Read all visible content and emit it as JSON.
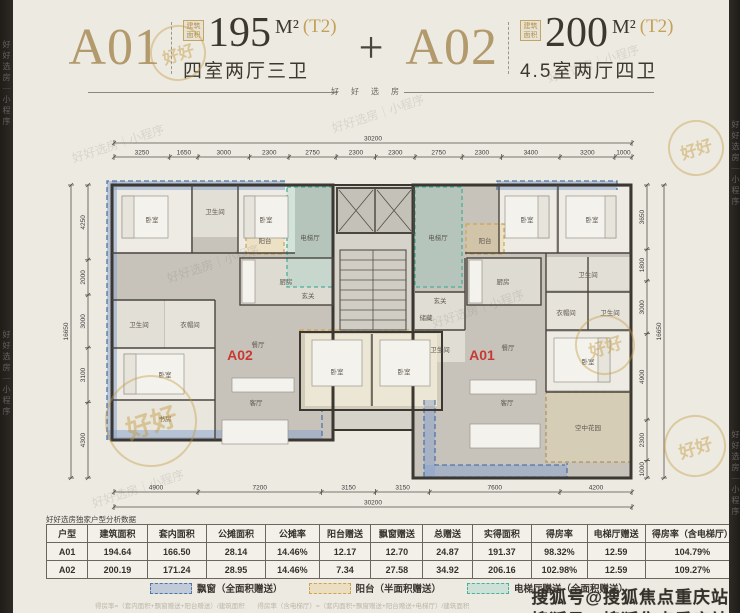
{
  "header": {
    "unit_a01": {
      "name": "A01",
      "area_label": "建筑面积",
      "area": "195",
      "unit": "M²",
      "tower": "(T2)",
      "layout": "四室两厅三卫"
    },
    "plus": "+",
    "unit_a02": {
      "name": "A02",
      "area_label": "建筑面积",
      "area": "200",
      "unit": "M²",
      "tower": "(T2)",
      "layout": "4.5室两厅四卫"
    },
    "divider_text": "好好选房"
  },
  "plan": {
    "unit_left_badge": "A02",
    "unit_right_badge": "A01",
    "room_labels": {
      "bedroom": "卧室",
      "bathroom": "卫生间",
      "kitchen": "厨房",
      "dining": "餐厅",
      "living": "客厅",
      "study": "书房",
      "closet": "衣帽间",
      "storage": "储藏",
      "foyer": "玄关",
      "balcony": "阳台",
      "elevator_hall": "电梯厅",
      "sky_garden": "空中花园"
    },
    "dims": {
      "top": {
        "total": 30200,
        "segments": [
          3250,
          1650,
          3000,
          2300,
          2750,
          2300,
          2300,
          2750,
          2300,
          3400,
          3200,
          1000
        ]
      },
      "bottom": {
        "total": 30200,
        "segments": [
          4900,
          7200,
          3150,
          3150,
          7600,
          4200
        ]
      },
      "left": {
        "total": 16650,
        "segments": [
          4250,
          2000,
          3000,
          3100,
          4300
        ]
      },
      "right": {
        "total": 16650,
        "segments": [
          3650,
          1800,
          3000,
          4900,
          2300,
          1000
        ]
      }
    }
  },
  "table": {
    "caption": "好好选房独家户型分析数据",
    "headers": [
      "户型",
      "建筑面积",
      "套内面积",
      "公摊面积",
      "公摊率",
      "阳台赠送",
      "飘窗赠送",
      "总赠送",
      "实得面积",
      "得房率",
      "电梯厅赠送",
      "得房率（含电梯厅）"
    ],
    "rows": [
      [
        "A01",
        "194.64",
        "166.50",
        "28.14",
        "14.46%",
        "12.17",
        "12.70",
        "24.87",
        "191.37",
        "98.32%",
        "12.59",
        "104.79%"
      ],
      [
        "A02",
        "200.19",
        "171.24",
        "28.95",
        "14.46%",
        "7.34",
        "27.58",
        "34.92",
        "206.16",
        "102.98%",
        "12.59",
        "109.27%"
      ]
    ]
  },
  "legend": {
    "items": [
      {
        "label": "飘窗（全面积赠送）",
        "color": "#4f74a8",
        "fill": "rgba(140,165,205,0.45)"
      },
      {
        "label": "阳台（半面积赠送）",
        "color": "#cfa54f",
        "fill": "rgba(235,200,130,0.35)"
      },
      {
        "label": "电梯厅赠送（全面积赠送）",
        "color": "#49b09c",
        "fill": "rgba(130,205,190,0.30)"
      }
    ]
  },
  "footnotes": {
    "formula_1": "得房率=（套内面积+飘窗赠送+阳台赠送）/建筑面积",
    "formula_2": "得房率（含电梯厅）=（套内面积+飘窗赠送+阳台赠送+电梯厅）/建筑面积"
  },
  "watermarks": {
    "sohu": "搜狐号@搜狐焦点重庆站",
    "side": "好好选房｜小程序",
    "stamp": "好好"
  },
  "colors": {
    "accent_gold": "#b29a6c",
    "badge_red": "#c53b33",
    "blue": "#4f74a8",
    "orange": "#cfa54f",
    "teal": "#49b09c"
  }
}
